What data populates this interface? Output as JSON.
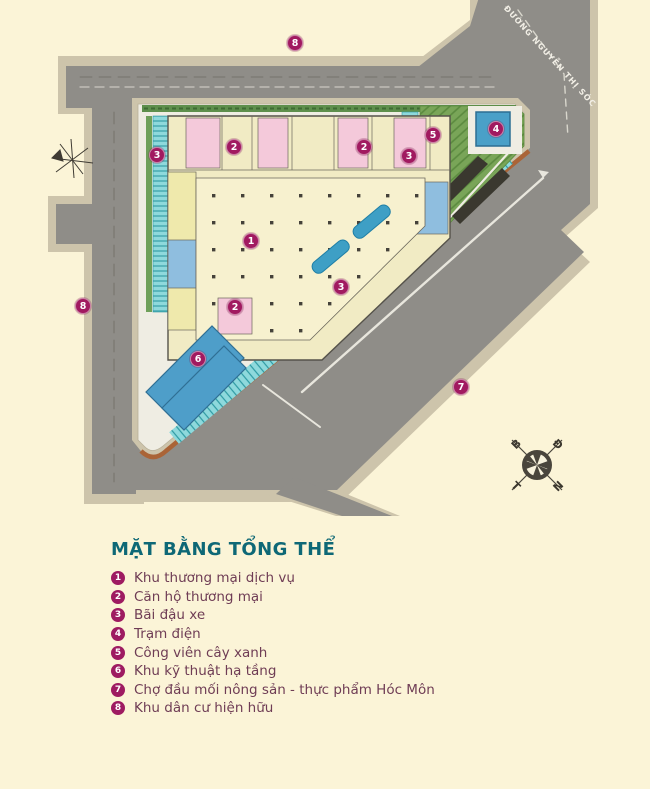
{
  "colors": {
    "background": "#FBF4D7",
    "road_gray": "#8F8D88",
    "sidewalk_tan": "#CDC4AB",
    "parcel_white": "#EFEDE3",
    "building_cream": "#F1EBC4",
    "room_pink": "#F4C9DA",
    "room_yellow": "#EFE9AC",
    "room_blue": "#8FBEDF",
    "parking_teal": "#8ED9DC",
    "park_green": "#79A558",
    "pool_blue": "#3E9FC5",
    "tech_blue": "#4E9EC9",
    "boundary_orange": "#AA6437",
    "badge_magenta": "#9E1B61",
    "legend_title_teal": "#0E6876",
    "legend_text": "#6F3D55"
  },
  "plan": {
    "road_label": "ĐƯỜNG NGUYỄN THỊ SÓC",
    "compass": {
      "b": "B",
      "d": "Đ",
      "t": "T",
      "n": "N"
    },
    "markers": [
      {
        "num": "1",
        "x": 251,
        "y": 241
      },
      {
        "num": "2",
        "x": 234,
        "y": 147
      },
      {
        "num": "2",
        "x": 364,
        "y": 147
      },
      {
        "num": "2",
        "x": 235,
        "y": 307
      },
      {
        "num": "3",
        "x": 157,
        "y": 155
      },
      {
        "num": "3",
        "x": 409,
        "y": 156
      },
      {
        "num": "3",
        "x": 341,
        "y": 287
      },
      {
        "num": "4",
        "x": 496,
        "y": 129
      },
      {
        "num": "5",
        "x": 433,
        "y": 135
      },
      {
        "num": "6",
        "x": 198,
        "y": 359
      },
      {
        "num": "7",
        "x": 461,
        "y": 387
      },
      {
        "num": "8",
        "x": 295,
        "y": 43
      },
      {
        "num": "8",
        "x": 83,
        "y": 306
      }
    ]
  },
  "legend": {
    "title": "MẶT BẰNG TỔNG THỂ",
    "items": [
      {
        "num": "1",
        "label": "Khu thương mại dịch vụ"
      },
      {
        "num": "2",
        "label": "Căn hộ thương mại"
      },
      {
        "num": "3",
        "label": "Bãi đậu xe"
      },
      {
        "num": "4",
        "label": "Trạm điện"
      },
      {
        "num": "5",
        "label": "Công viên cây xanh"
      },
      {
        "num": "6",
        "label": "Khu kỹ thuật hạ tầng"
      },
      {
        "num": "7",
        "label": "Chợ đầu mối nông sản - thực phẩm Hóc Môn"
      },
      {
        "num": "8",
        "label": "Khu dân cư hiện hữu"
      }
    ]
  }
}
